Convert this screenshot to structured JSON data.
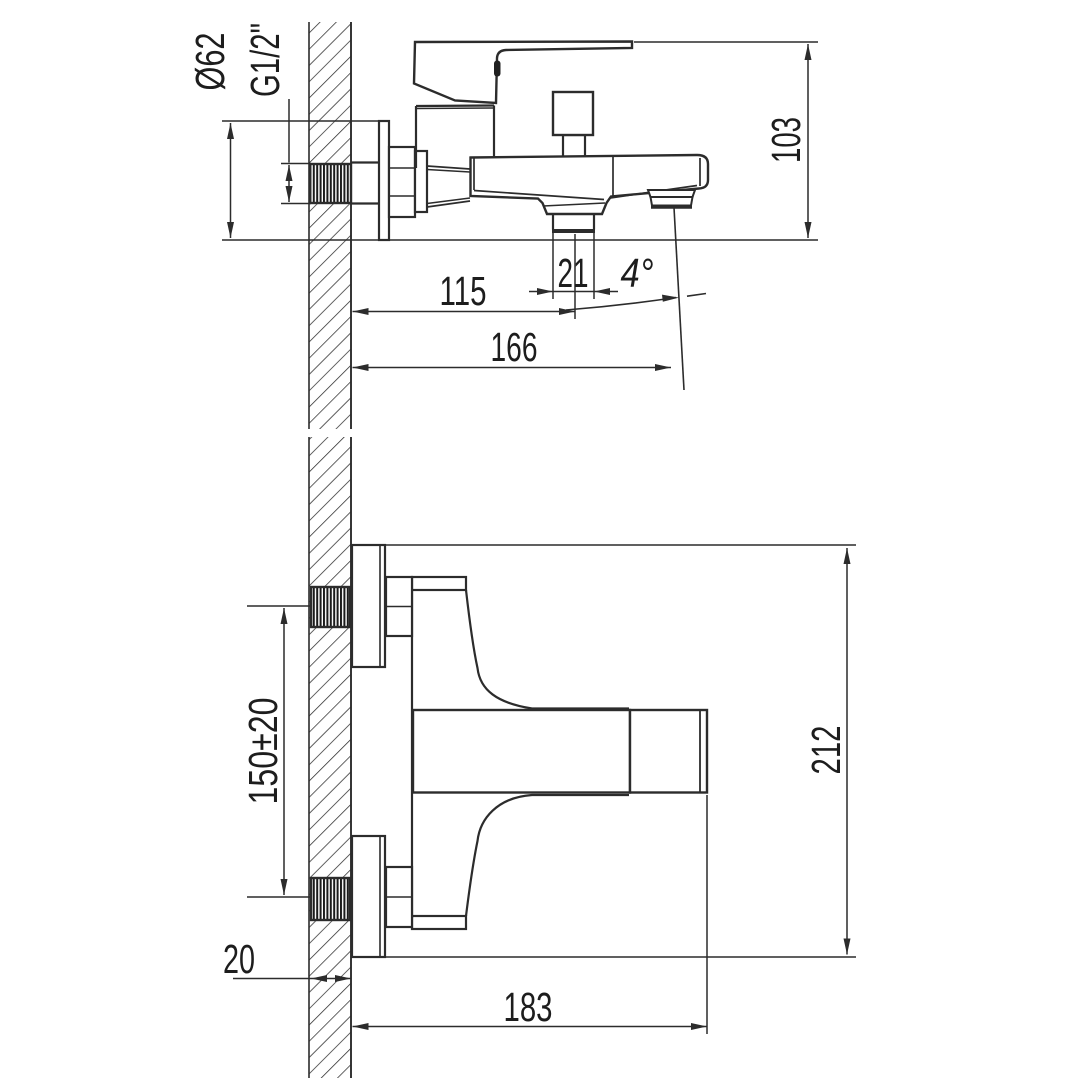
{
  "drawing": {
    "background": "#ffffff",
    "line_color": "#2c2c2c",
    "views": {
      "side_view": {
        "labels": {
          "escutcheon_diameter": "Ø62",
          "thread_size": "G1/2\"",
          "height": "103",
          "wall_to_diverter": "115",
          "diverter_width": "21",
          "spout_angle": "4°",
          "wall_to_spout": "166"
        }
      },
      "plan_view": {
        "labels": {
          "supply_centers": "150±20",
          "wall_thickness": "20",
          "wall_to_body_end": "183",
          "overall_depth": "212"
        }
      }
    }
  }
}
